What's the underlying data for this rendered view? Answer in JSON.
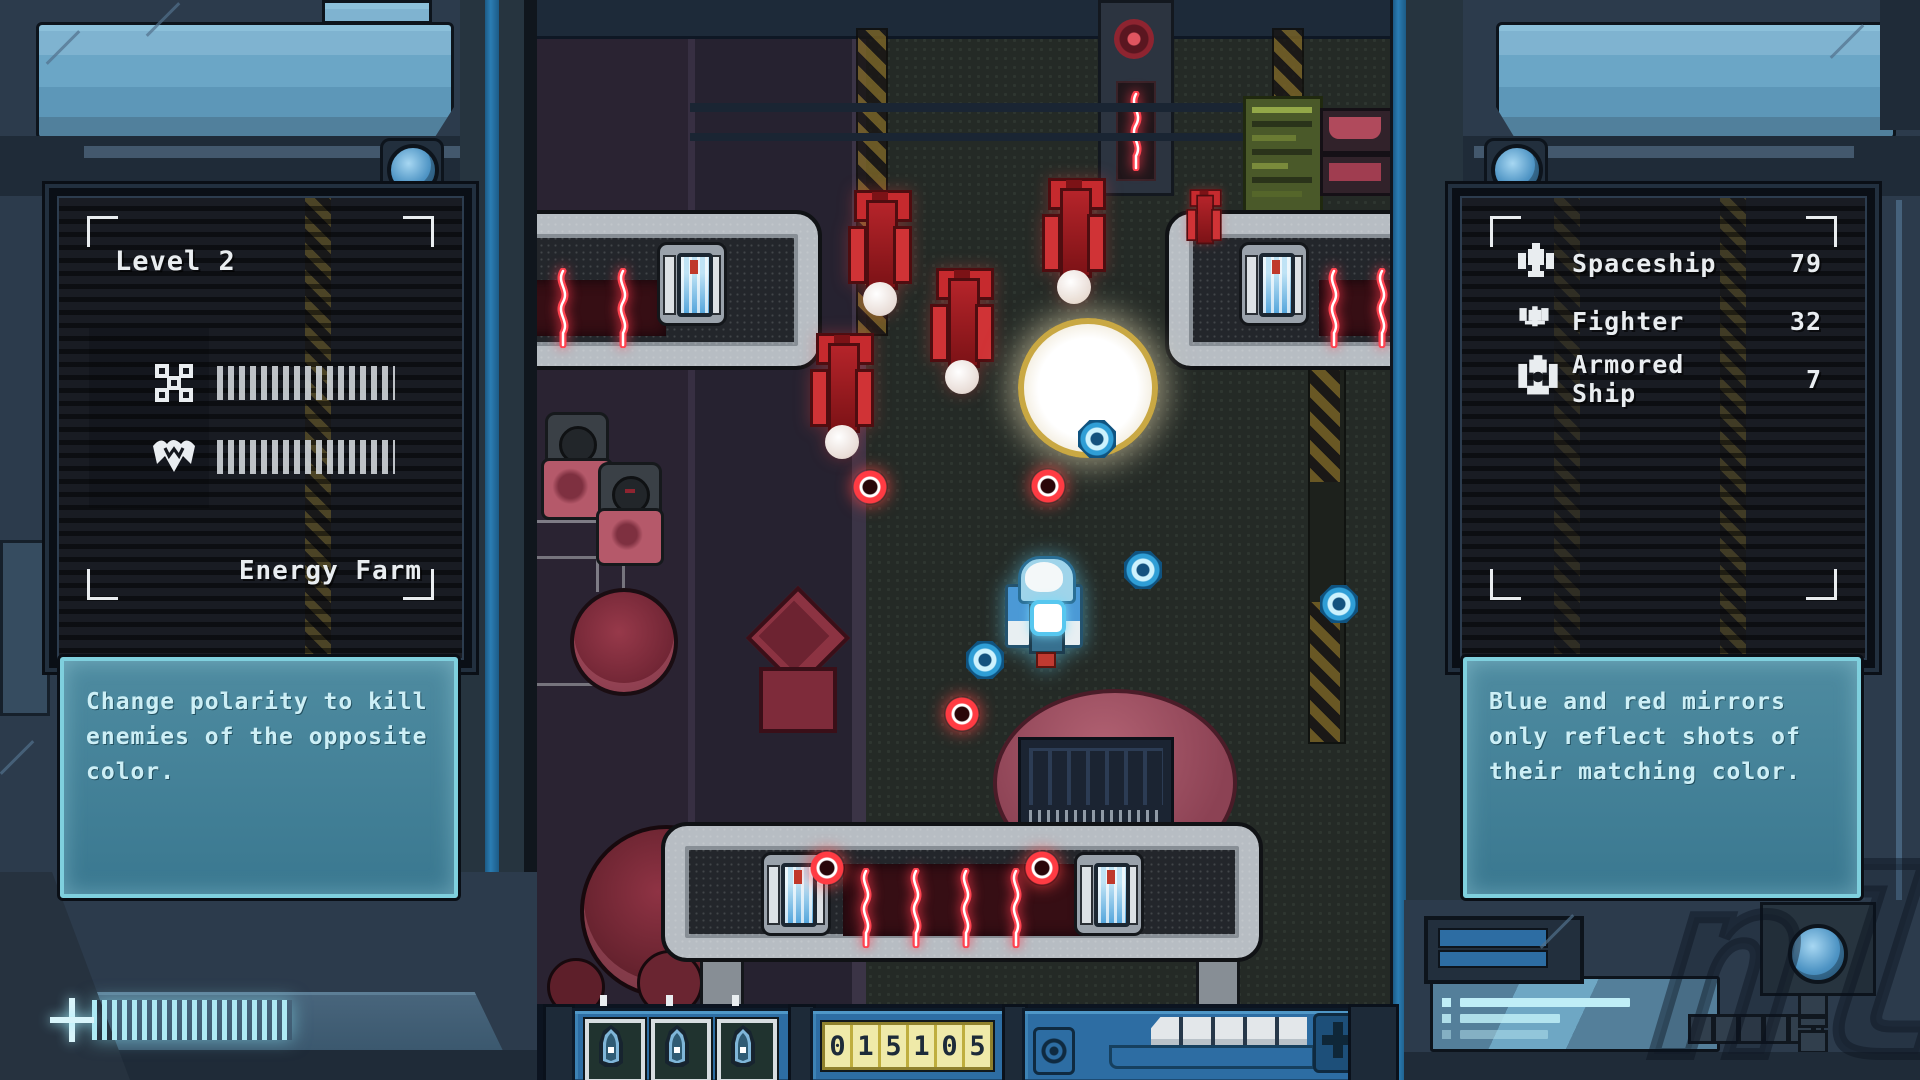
{
  "left_panel": {
    "level_label": "Level 2",
    "location_label": "Energy Farm",
    "objectives": [
      {
        "icon": "enemy-squadron-icon"
      },
      {
        "icon": "boss-ship-icon"
      }
    ],
    "tip_text": "Change polarity to kill enemies of the opposite color."
  },
  "right_panel": {
    "kill_stats": [
      {
        "icon": "spaceship-icon",
        "label": "Spaceship",
        "count": "79"
      },
      {
        "icon": "fighter-icon",
        "label": "Fighter",
        "count": "32"
      },
      {
        "icon": "armored-ship-icon",
        "label": "Armored Ship",
        "count": "7"
      }
    ],
    "tip_text": "Blue and red mirrors only reflect shots of their matching color."
  },
  "hud": {
    "lives_count": 3,
    "score": "015105",
    "score_digits": [
      "0",
      "1",
      "5",
      "1",
      "0",
      "5"
    ],
    "energy_segments": 5
  },
  "colors": {
    "frame": "#2e4052",
    "frame_dark": "#1f2b38",
    "glass": "#6ba6c6",
    "accent_blue_strip": "#2b7db3",
    "hud_blue": "#2d6da3",
    "tip_bg": "#44839a",
    "tip_border": "#7fd0de",
    "tip_text": "#cdeff6",
    "text_white": "#e9edf0",
    "score_cell": "#efeaa9",
    "score_text": "#1d2b39",
    "enemy_red": "#c9252b",
    "player_blue": "#5aa7dc",
    "bullet_red": "#ff3b43",
    "bullet_blue": "#4fc3f2",
    "arc_red": "#ff4350",
    "explosion_core": "#f5f1e6",
    "explosion_ring": "#c9a843",
    "hazard_yellow": "#8a7429",
    "platform_grey": "#b7bdc3",
    "dome_pink": "#a85a6c"
  }
}
